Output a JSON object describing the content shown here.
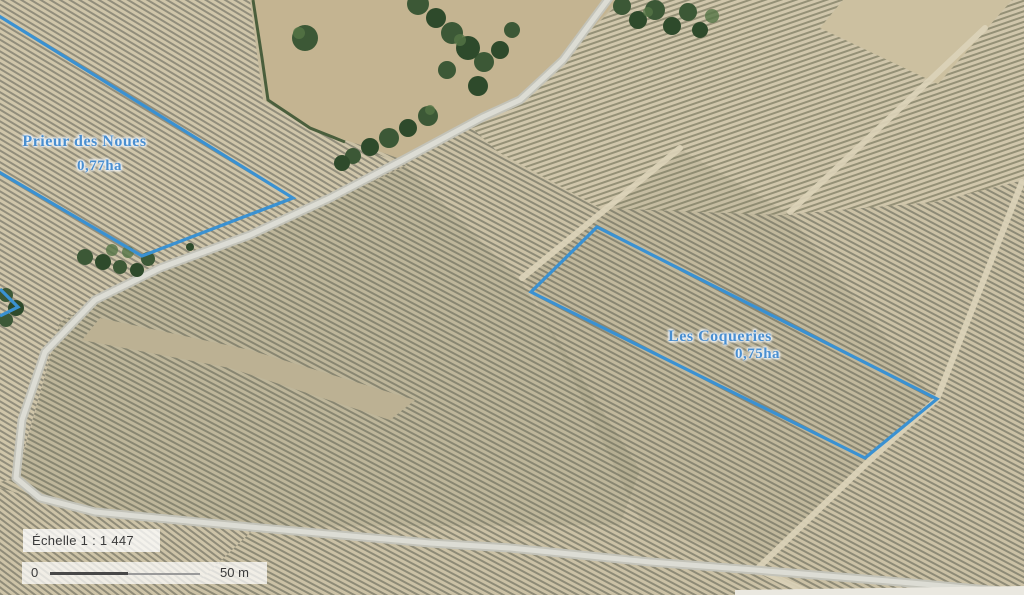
{
  "map": {
    "parcels": [
      {
        "name": "Prieur des Noues",
        "area": "0,77ha"
      },
      {
        "name": "Les Coqueries",
        "area": "0,75ha"
      }
    ],
    "scale_label": "Échelle 1 :  1 447",
    "scalebar": {
      "start": "0",
      "end": "50 m"
    },
    "colors": {
      "parcel_outline": "#3a91d2",
      "parcel_label": "#4a8fd0"
    }
  }
}
